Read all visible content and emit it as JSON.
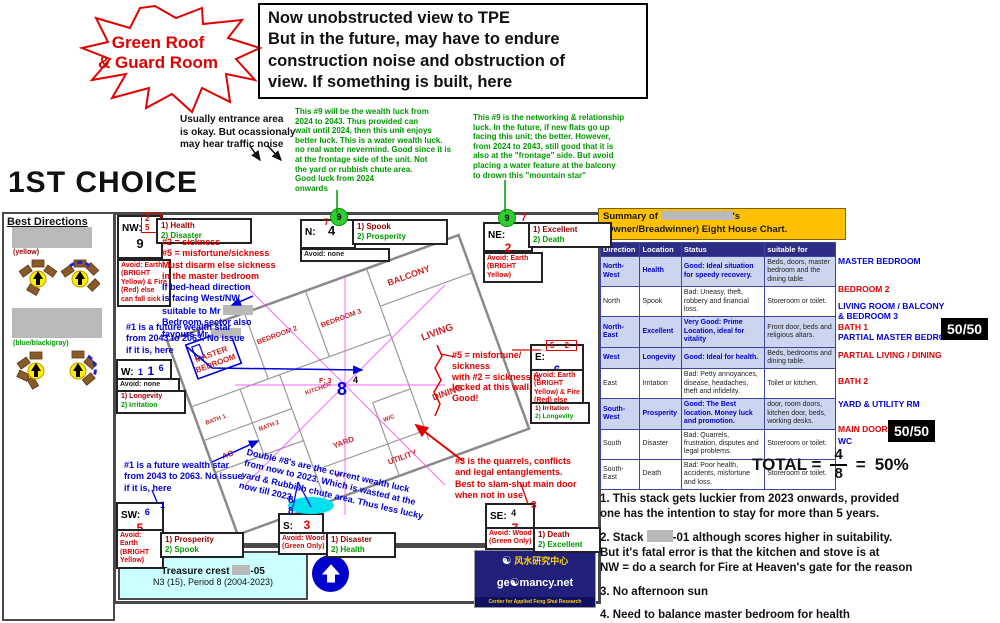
{
  "colors": {
    "accent_red": "#e00000",
    "accent_green": "#009900",
    "accent_blue": "#0000dd",
    "gold": "#ffc000",
    "navy": "#2d2d86",
    "table_good_bg": "#ccd5ef",
    "cyan_box": "#ccffff",
    "badge_bg": "#000000"
  },
  "starburst": {
    "text": "Green Roof\n& Guard Room"
  },
  "top_note": {
    "text": "Now unobstructed view to TPE\nBut in the future, may have to endure\nconstruction noise and obstruction of\nview. If something is built, here"
  },
  "entrance_note": {
    "text": "Usually entrance area\nis okay. But ocassionaly\nmay hear traffic noise"
  },
  "green_note_1": {
    "text": "This #9 will be the wealth luck from\n2024 to 2043. Thus provided can\nwait until 2024, then this unit enjoys\nbetter luck. This is a water wealth luck.\nno real water nevermind. Good since it is\nat the frontage side of the unit. Not\nthe yard or rubbish chute area.\nGood luck from 2024\nonwards"
  },
  "green_note_2": {
    "text": "This #9 is the networking & relationship\nluck. In the future, if new flats go up\nfacing this unit; the better. However,\nfrom 2024 to 2043, still good that it is\nalso at the \"frontage\" side. But avoid\nplacing a water feature at the balcony\nto drown this \"mountain star\""
  },
  "choice_title": "1ST CHOICE",
  "best_directions": {
    "title": "Best Directions",
    "caption1": "(yellow)",
    "caption2": "(blue/black/gray)"
  },
  "compass": {
    "nw": {
      "label": "NW:",
      "pair": "2 5",
      "main": "9",
      "luck1": "1) Health",
      "luck2": "2) Disaster",
      "avoid": "Avoid: Earth (BRIGHT Yellow) & Fire (Red) else can fall sick"
    },
    "n": {
      "label": "N:",
      "sup": "7",
      "circle": "9",
      "main": "4",
      "luck1": "1) Spook",
      "luck2": "2) Prosperity",
      "avoid": "Avoid: none"
    },
    "ne": {
      "label": "NE:",
      "circle": "9",
      "sup": "7",
      "main": "2",
      "luck1": "1) Excellent",
      "luck2": "2) Death",
      "avoid": "Avoid: Earth (BRIGHT Yellow)"
    },
    "w": {
      "label": "W:",
      "n1": "1",
      "n2": "1",
      "n3": "6",
      "luck1": "1) Longevity",
      "luck2": "2) Irritation",
      "avoid": "Avoid: none"
    },
    "e": {
      "label": "E:",
      "pair": "5 2",
      "main": "6",
      "luck1": "1) Irritation",
      "luck2": "2) Longevity",
      "avoid": "Avoid: Earth (BRIGHT Yellow) & Fire (Red) else can fall sick"
    },
    "sw": {
      "label": "SW:",
      "n1": "6",
      "n2": "1",
      "main": "5",
      "luck1": "1) Prosperity",
      "luck2": "2) Spook",
      "avoid": "Avoid: Earth (BRIGHT Yellow)"
    },
    "s": {
      "label": "S:",
      "main": "3",
      "ellipse": "8 8",
      "luck1": "1) Disaster",
      "luck2": "2) Health",
      "avoid": "Avoid: Wood (Green Only)"
    },
    "se": {
      "label": "SE:",
      "n1": "4",
      "main": "7",
      "n2": "3",
      "luck1": "1) Death",
      "luck2": "2) Excellent",
      "avoid": "Avoid: Wood (Green Only)"
    }
  },
  "floorplan": {
    "labels": {
      "master_l1": "MASTER",
      "master_l2": "BEDROOM",
      "bedroom2": "BEDROOM 2",
      "bedroom3": "BEDROOM 3",
      "balcony": "BALCONY",
      "living": "LIVING",
      "dining": "DINING",
      "kitchen": "KITCHEN",
      "bath1": "BATH 1",
      "bath2": "BATH 2",
      "ac": "AC",
      "yard": "YARD",
      "wc": "W/C",
      "utility": "UTILITY",
      "db": "DB"
    },
    "center": {
      "star": "8",
      "num": "4",
      "f": "F: 3"
    }
  },
  "annotations": {
    "sickness_red": "#2 = sickness\n#5 = misfortune/sickness\nMust disarm else sickness\nin the master bedroom",
    "bedhead_l12": "If bed-head direction\nis facing West/NW",
    "bedhead_l3": "suitable to Mr",
    "bedhead_l4": "Bedroom sector also",
    "bedhead_l5": "favours Mr",
    "wealth_top": "#1 is a future wealth star\nfrom 2043 to 2063. No issue\nif it is, here",
    "locked_wall": "#5 = misfortune/\nsickness\nwith #2 = sickness is\nlocked at this wall.\nGood!",
    "wealth_bottom": "#1 is a future wealth star\nfrom 2043 to 2063. No issue\nif it is, here",
    "double8": "Double #8's are the current wealth luck\nfrom now to 2023. Which is wasted at the\nyard & Rubbish chute area. Thus less lucky\nnow till 2023",
    "quarrels": "#3 is the quarrels, conflicts\nand legal entanglements.\nBest to slam-shut main door\nwhen not in use"
  },
  "summary": {
    "prefix": "Summary of",
    "possessive": "'s",
    "line2": "(Owner/Breadwinner) Eight House Chart."
  },
  "table": {
    "headers": [
      "Direction",
      "Location",
      "Status",
      "suitable for"
    ],
    "rows": [
      {
        "direction": "North-West",
        "location": "Health",
        "status": "Good: Ideal situation for speedy recovery.",
        "suitable": "Beds, doors, master bedroom and the dining table."
      },
      {
        "direction": "North",
        "location": "Spook",
        "status": "Bad: Uneasy, theft, robbery and financial loss.",
        "suitable": "Storeroom or toilet."
      },
      {
        "direction": "North-East",
        "location": "Excellent",
        "status": "Very Good: Prime Location, ideal for vitality",
        "suitable": "Front door, beds and religious altars."
      },
      {
        "direction": "West",
        "location": "Longevity",
        "status": "Good: Ideal for health.",
        "suitable": "Beds, bedrooms and dining table."
      },
      {
        "direction": "East",
        "location": "Irritation",
        "status": "Bad: Petty annoyances, disease, headaches, theft and infidelity.",
        "suitable": "Toilet or kitchen."
      },
      {
        "direction": "South-West",
        "location": "Prosperity",
        "status": "Good: The Best location. Money luck and promotion.",
        "suitable": "door, room doors, kitchen door, beds, working desks."
      },
      {
        "direction": "South",
        "location": "Disaster",
        "status": "Bad: Quarrels, frustration, disputes and legal problems.",
        "suitable": "Storeroom or toilet."
      },
      {
        "direction": "South-East",
        "location": "Death",
        "status": "Bad: Poor health, accidents, misfortune and loss.",
        "suitable": "Storeroom or toilet."
      }
    ]
  },
  "room_labels": {
    "master": "MASTER BEDROOM",
    "bedroom2": "BEDROOM 2",
    "living_l1": "LIVING ROOM / BALCONY",
    "living_l2": "& BEDROOM 3",
    "bath1": "BATH 1",
    "partial_master": "PARTIAL MASTER BEDROOM",
    "badge1": "50/50",
    "partial_living": "PARTIAL LIVING / DINING",
    "bath2": "BATH 2",
    "yard": "YARD & UTILITY RM",
    "maindoor": "MAIN DOOR",
    "wc": "WC",
    "badge2": "50/50"
  },
  "total": {
    "label": "TOTAL =",
    "numerator": "4",
    "denominator": "8",
    "result_eq": "=",
    "result": "50%"
  },
  "notes": {
    "n1": "1. This stack gets luckier from 2023 onwards, provided\none has the intention to stay for more than 5 years.",
    "n2_prefix": "2. Stack",
    "n2_suffix": "-01 although scores higher in suitability.",
    "n2_l2": "But it's fatal error is that the kitchen and stove is at\nNW = do a search for Fire at Heaven's gate for the reason",
    "n3": "3. No afternoon sun",
    "n4": "4. Need to balance master bedroom for health"
  },
  "treasure": {
    "prefix": "Treasure crest",
    "suffix": "-05",
    "line2": "N3 (15), Period 8 (2004-2023)"
  },
  "logo": {
    "chinese": "风水研究中心",
    "name": "ge☯mancy.net",
    "tagline": "Center for Applied Feng Shui Research"
  }
}
